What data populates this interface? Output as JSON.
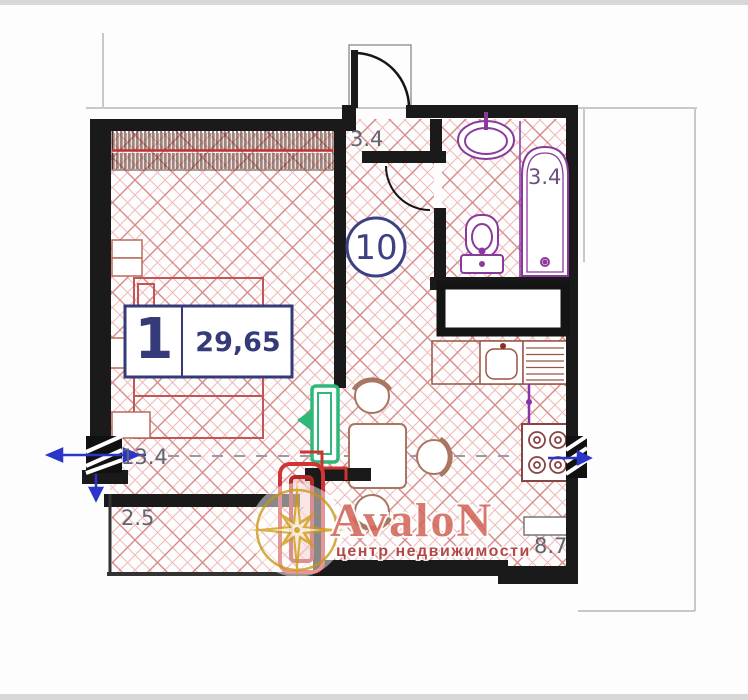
{
  "plan": {
    "unit_circle": "10",
    "info_box": {
      "rooms": "1",
      "area": "29,65"
    },
    "dims": {
      "hall": "3.4",
      "bath": "3.4",
      "bedroom_width": "13.4",
      "balcony": "2.5",
      "kitchen": "8.7"
    },
    "watermark": {
      "brand": "AvaloN",
      "tagline": "центр недвижимости"
    },
    "colors": {
      "wall": "#1a1a1a",
      "hatch_light": "#f0b9b9",
      "hatch_strong": "#d98888",
      "navy": "#353a78",
      "label_gray": "#63646f",
      "purple": "#8a3a9a",
      "red": "#cc3333",
      "green": "#2eb87a",
      "gold": "#cfa32c",
      "brand_salmon": "#d4685c",
      "brand_dark_red": "#a83232",
      "blue_marker": "#2b35c8"
    }
  }
}
